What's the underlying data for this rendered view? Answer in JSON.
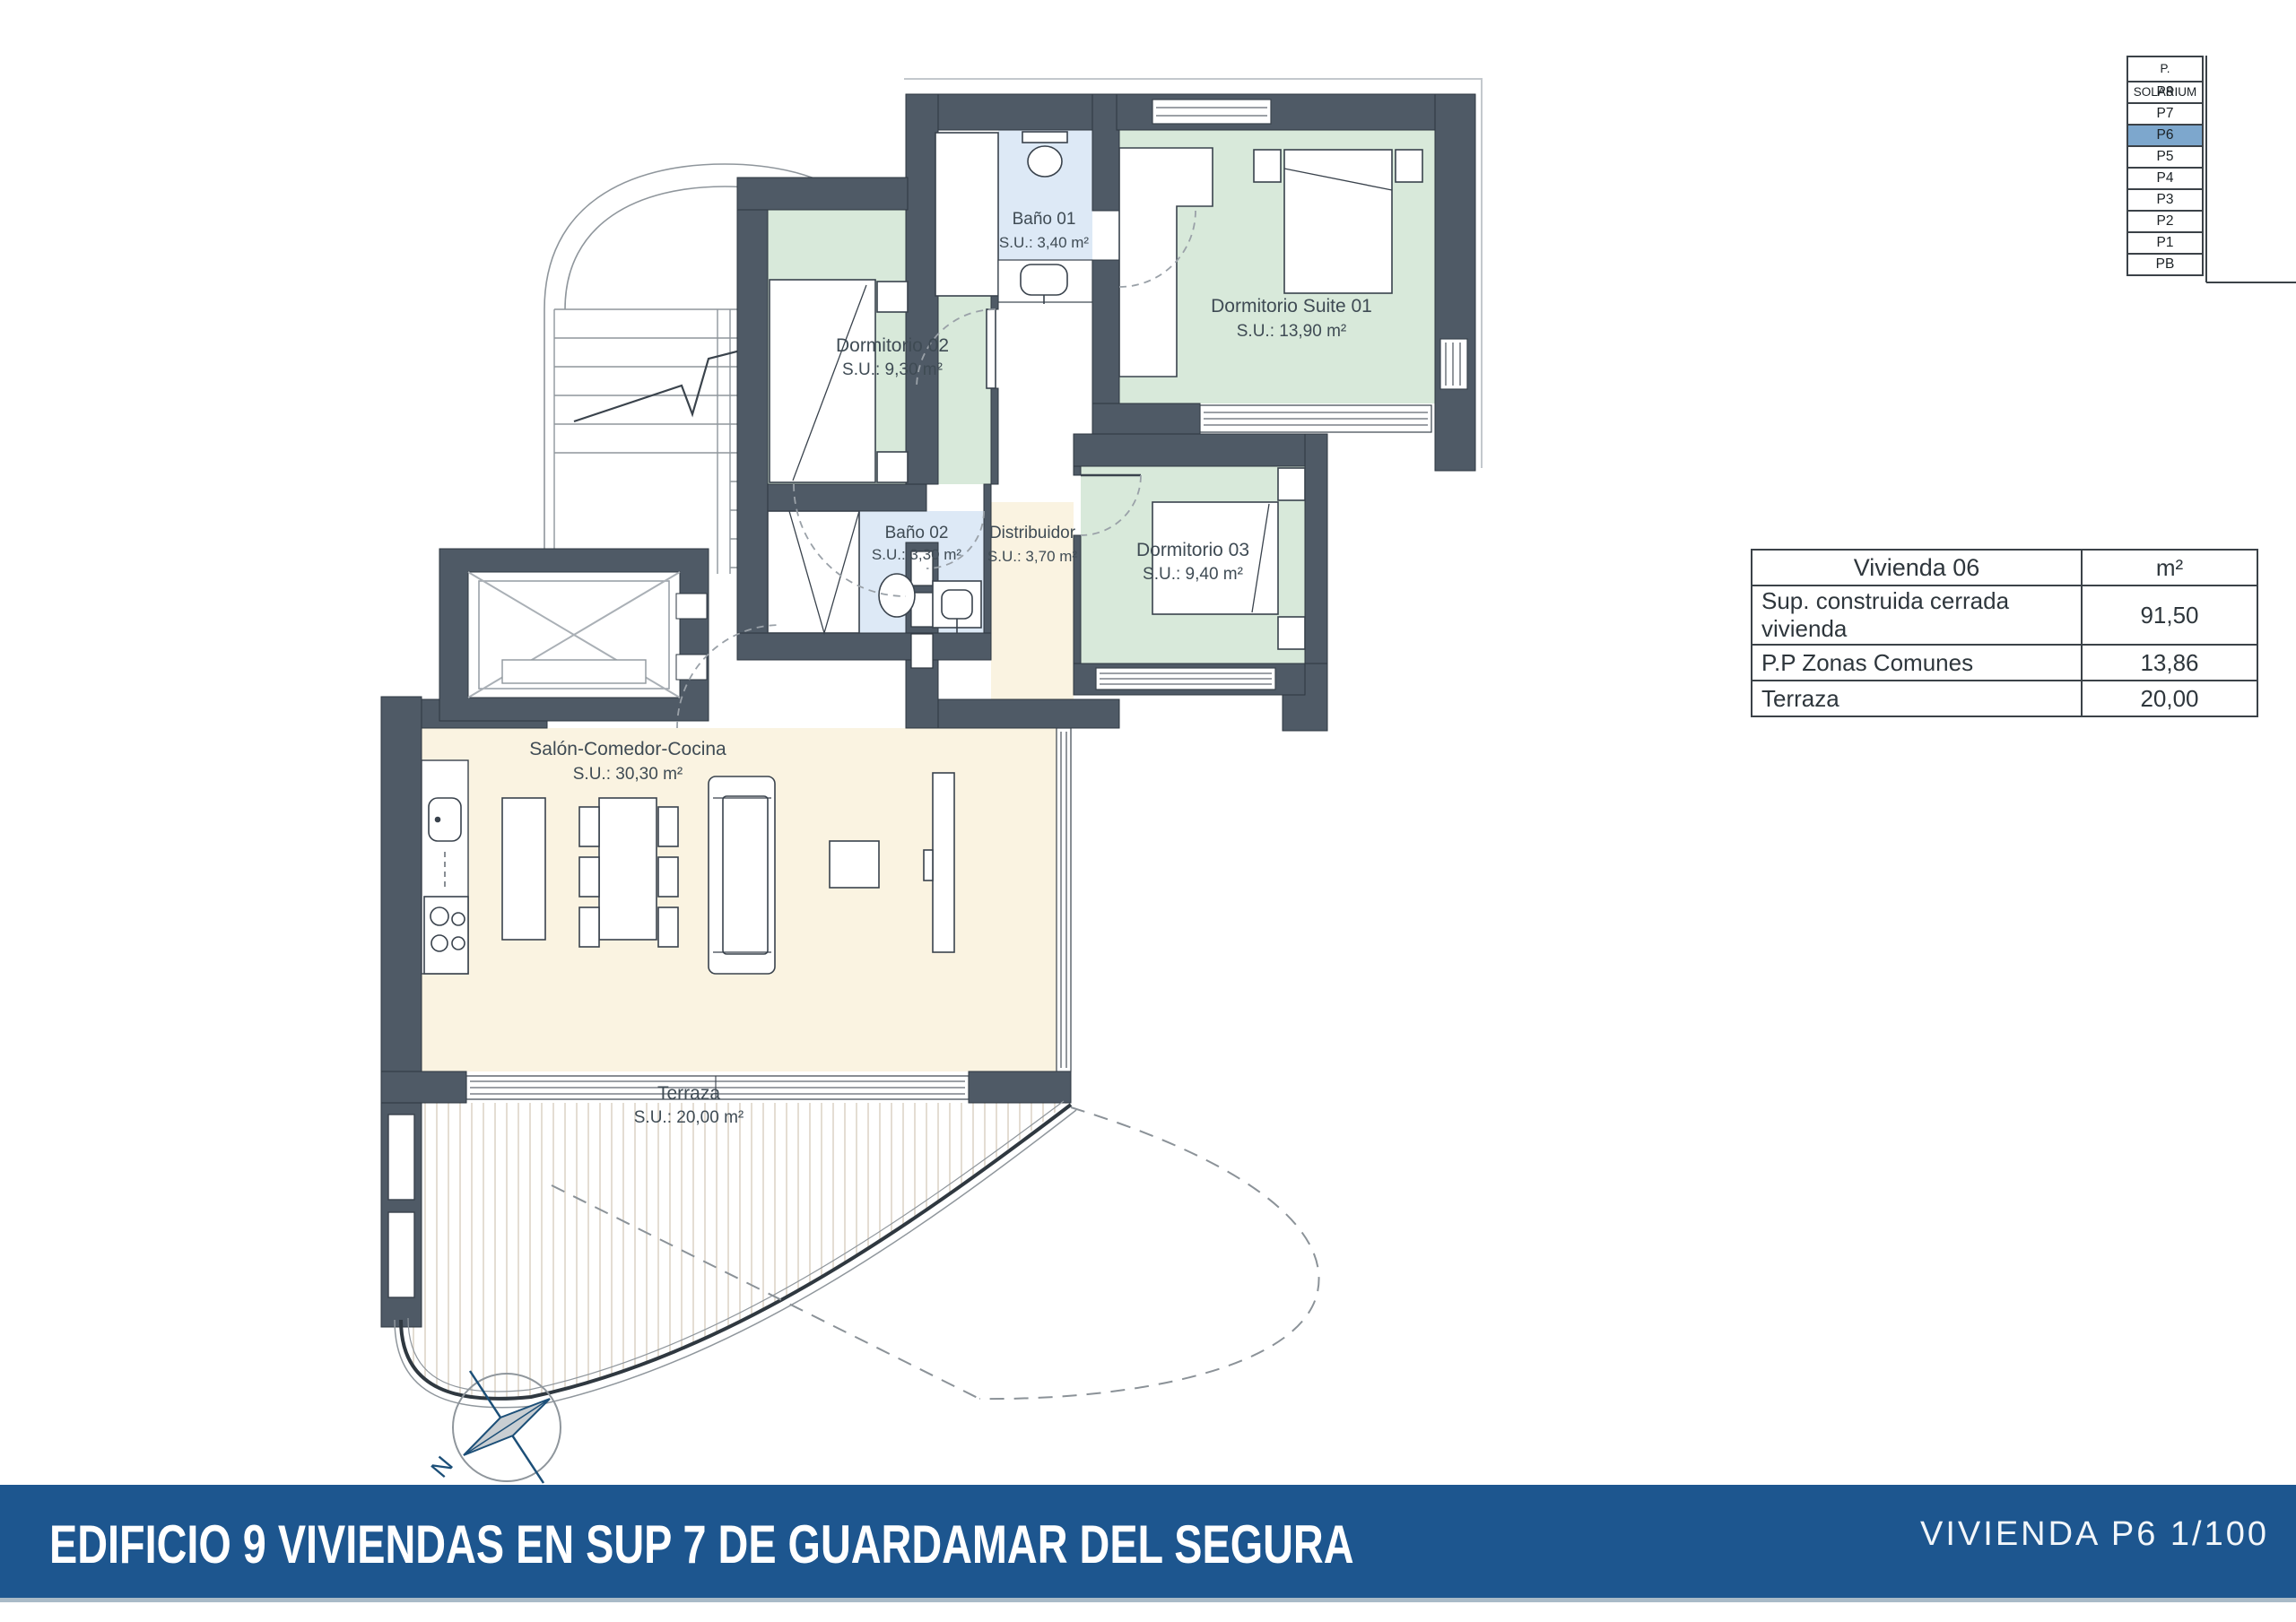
{
  "floor_selector": {
    "header": "P. SOLARIUM",
    "floors": [
      "P8",
      "P7",
      "P6",
      "P5",
      "P4",
      "P3",
      "P2",
      "P1",
      "PB"
    ],
    "selected": "P6",
    "highlight_color": "#7da7cd"
  },
  "area_table": {
    "title": "Vivienda 06",
    "unit_header": "m²",
    "rows": [
      {
        "label": "Sup. construida cerrada vivienda",
        "value": "91,50"
      },
      {
        "label": "P.P Zonas Comunes",
        "value": "13,86"
      },
      {
        "label": "Terraza",
        "value": "20,00"
      }
    ]
  },
  "rooms": [
    {
      "name": "Baño 01",
      "area": "S.U.: 3,40 m²"
    },
    {
      "name": "Dormitorio 02",
      "area": "S.U.: 9,30 m²"
    },
    {
      "name": "Dormitorio Suite 01",
      "area": "S.U.: 13,90 m²"
    },
    {
      "name": "Baño 02",
      "area": "S.U.: 3,30 m²"
    },
    {
      "name": "Distribuidor",
      "area": "S.U.: 3,70 m²"
    },
    {
      "name": "Dormitorio 03",
      "area": "S.U.: 9,40 m²"
    },
    {
      "name": "Salón-Comedor-Cocina",
      "area": "S.U.: 30,30 m²"
    },
    {
      "name": "Terraza",
      "area": "S.U.: 20,00 m²"
    }
  ],
  "title_bar": {
    "title": "EDIFICIO 9 VIVIENDAS EN SUP 7 DE GUARDAMAR DEL SEGURA",
    "plan_label": "VIVIENDA P6 1/100",
    "bar_color": "#1d568f"
  },
  "compass": {
    "label": "N"
  },
  "colors": {
    "wall": "#4f5a66",
    "bedroom_green": "#d8e9da",
    "bath_blue": "#dde9f6",
    "living_cream": "#faf3e1",
    "selected_floor_blue": "#7da7cd",
    "title_bar_blue": "#1d568f"
  }
}
